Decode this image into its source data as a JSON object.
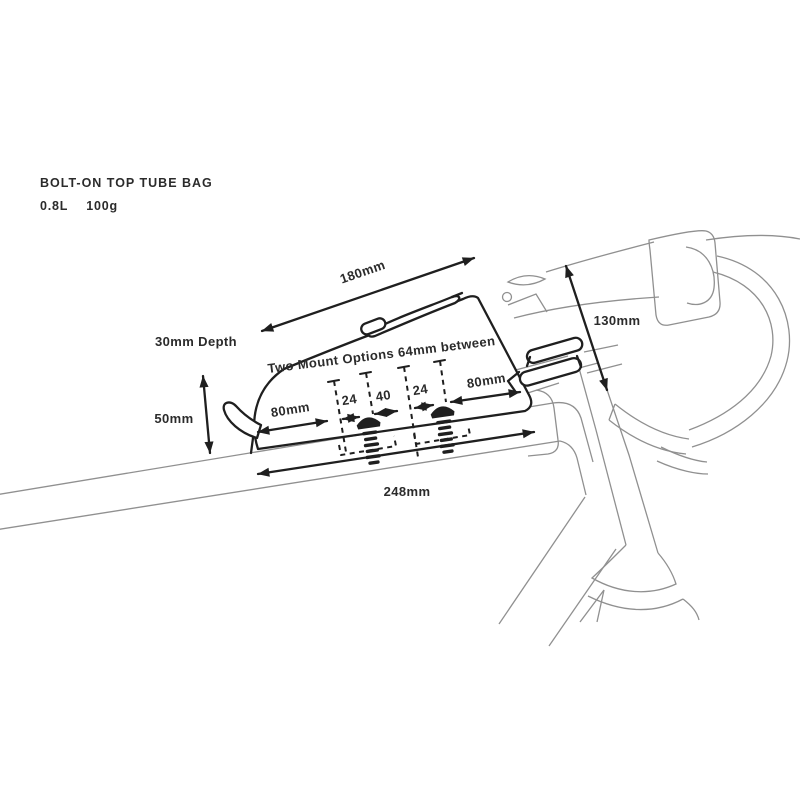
{
  "header": {
    "title": "BOLT-ON TOP TUBE BAG",
    "volume": "0.8L",
    "weight": "100g"
  },
  "diagram": {
    "labels": {
      "top_length": "180mm",
      "depth": "30mm Depth",
      "front_height": "50mm",
      "stack_height": "130mm",
      "mount_note": "Two Mount Options 64mm between",
      "seg_80_left": "80mm",
      "seg_24_left": "24",
      "seg_40": "40",
      "seg_24_right": "24",
      "seg_80_right": "80mm",
      "base_length": "248mm"
    },
    "colors": {
      "ink": "#1f1f1f",
      "frame_line": "#909090",
      "text": "#2b2b2b",
      "background": "#ffffff"
    }
  }
}
